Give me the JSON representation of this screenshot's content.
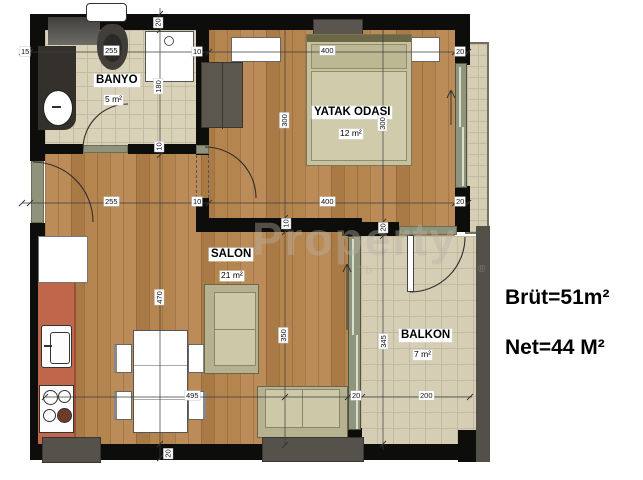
{
  "summary": {
    "brut": "Brüt=51m²",
    "net": "Net=44 M²"
  },
  "watermark": {
    "main": "Property",
    "small": "ть",
    "reg": "®"
  },
  "rooms": {
    "banyo": {
      "name": "BANYO",
      "area": "5 m²"
    },
    "yatak": {
      "name": "YATAK ODASI",
      "area": "12 m²"
    },
    "salon": {
      "name": "SALON",
      "area": "21 m²"
    },
    "balkon": {
      "name": "BALKON",
      "area": "7 m²"
    }
  },
  "dims": {
    "h1_15": "15",
    "h1_255": "255",
    "h1_10": "10",
    "h1_400": "400",
    "h1_20": "20",
    "h2_255": "255",
    "h2_10": "10",
    "h2_400": "400",
    "h2_20": "20",
    "h3_495": "495",
    "h3_20": "20",
    "h3_200": "200",
    "v1_20": "20",
    "v1_180": "180",
    "v1_10": "10",
    "v1_470": "470",
    "v1_20b": "20",
    "v2_300": "300",
    "v2_10": "10",
    "v2_350": "350",
    "v3_300": "300",
    "v3_20": "20",
    "v3_345": "345"
  },
  "palette": {
    "wall": "#0d0d0c",
    "wood": "#b3824f",
    "tile": "#d9d1b8",
    "kitchen_counter": "#c0664b",
    "window_green": "#8f947c",
    "furniture_beige": "#ccc8a8",
    "furniture_gray": "#55524b"
  }
}
